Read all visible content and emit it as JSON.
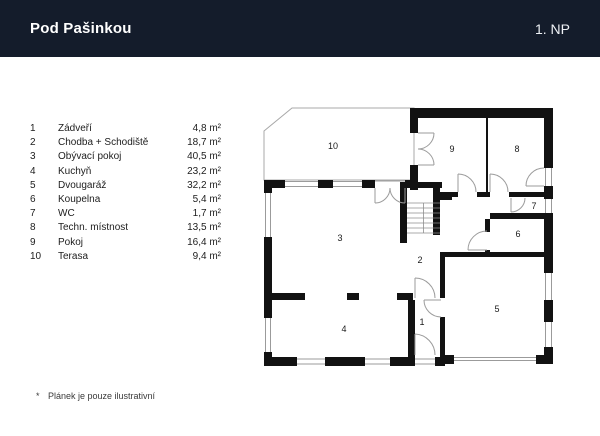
{
  "header": {
    "title": "Pod Pašinkou",
    "floor": "1. NP"
  },
  "legend": {
    "rows": [
      {
        "num": "1",
        "name": "Zádveří",
        "area": "4,8 m²"
      },
      {
        "num": "2",
        "name": "Chodba + Schodiště",
        "area": "18,7 m²"
      },
      {
        "num": "3",
        "name": "Obývací pokoj",
        "area": "40,5 m²"
      },
      {
        "num": "4",
        "name": "Kuchyň",
        "area": "23,2 m²"
      },
      {
        "num": "5",
        "name": "Dvougaráž",
        "area": "32,2 m²"
      },
      {
        "num": "6",
        "name": "Koupelna",
        "area": "5,4 m²"
      },
      {
        "num": "7",
        "name": "WC",
        "area": "1,7 m²"
      },
      {
        "num": "8",
        "name": "Techn. místnost",
        "area": "13,5 m²"
      },
      {
        "num": "9",
        "name": "Pokoj",
        "area": "16,4 m²"
      },
      {
        "num": "10",
        "name": "Terasa",
        "area": "9,4 m²"
      }
    ]
  },
  "plan": {
    "room_labels": {
      "r1": "1",
      "r2": "2",
      "r3": "3",
      "r4": "4",
      "r5": "5",
      "r6": "6",
      "r7": "7",
      "r8": "8",
      "r9": "9",
      "r10": "10"
    }
  },
  "footnote": {
    "marker": "*",
    "text": "Plánek je pouze ilustrativní"
  },
  "colors": {
    "header_bg": "#141c2b",
    "wall": "#121212",
    "thin_line": "#9b9b9b"
  }
}
